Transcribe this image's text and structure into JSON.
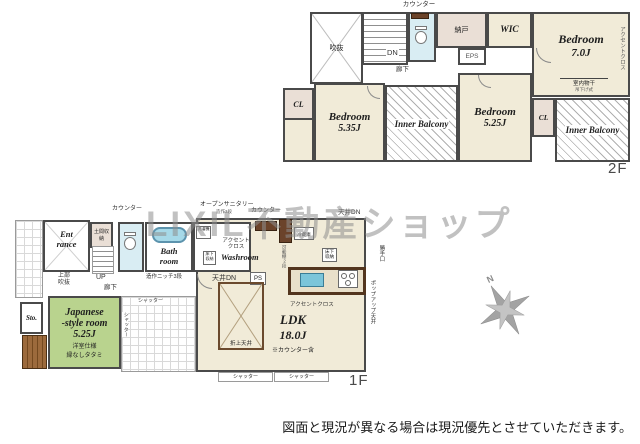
{
  "watermark": "LIXIL不動産ショップ",
  "disclaimer": "図面と現況が異なる場合は現況優先とさせていただきます。",
  "compass": {
    "north": "N"
  },
  "colors": {
    "floor_beige": "#f1ebd8",
    "closet_pink": "#eadfd6",
    "water_blue": "#d9edf3",
    "tatami_green": "#b9d38e",
    "wood_brown": "#6b432a",
    "wall_gray": "#4a4a4a",
    "watermark_gray": "#8f8f8f"
  },
  "f2": {
    "floor_label": "2F",
    "counter": "カウンター",
    "atrium": "吹抜",
    "dn": "DN",
    "hallway": "廊下",
    "nando": "納戸",
    "eps": "EPS",
    "wic": "WIC",
    "bed7_name": "Bedroom",
    "bed7_size": "7.0J",
    "accent_cloth": "アクセントクロス",
    "monohoshi": "室内物干",
    "monohoshi_sub": "吊下げ式",
    "cl_left": "CL",
    "bed535_name": "Bedroom",
    "bed535_size": "5.35J",
    "inner_balcony1": "Inner Balcony",
    "bed525_name": "Bedroom",
    "bed525_size": "5.25J",
    "cl_right": "CL",
    "inner_balcony2": "Inner Balcony"
  },
  "f1": {
    "floor_label": "1F",
    "entrance_l1": "Ent",
    "entrance_l2": "rance",
    "doma": "土間収納",
    "counter1": "カウンター",
    "open_sanitary": "オープンサニタリー",
    "open_sanitary_sub": "造作3段",
    "counter2": "カウンター",
    "ceiling_dn_top": "天井DN",
    "washer": "洗濯機",
    "bath_l1": "Bath",
    "bath_l2": "room",
    "accent1_l1": "アクセント",
    "accent1_l2": "クロス",
    "washroom": "Washroom",
    "floor_storage1": "床下収納",
    "fridge": "冷蔵庫",
    "movable_shelf": "可動棚2段",
    "floor_storage2": "床下収納",
    "katteguchi": "勝手口",
    "popup_ceiling": "ポップアップ天井",
    "up": "UP",
    "hallway": "廊下",
    "upper_void": "上部吹抜",
    "niche": "造作ニッチ3段",
    "ceiling_dn2": "天井DN",
    "ps": "PS",
    "sto": "Sto.",
    "jp_l1": "Japanese",
    "jp_l2": "-style room",
    "jp_size": "5.25J",
    "jp_sub1": "洋室仕様",
    "jp_sub2": "縁なしタタミ",
    "shutter": "シャッター",
    "oriage": "折上天井",
    "ldk_name": "LDK",
    "ldk_size": "18.0J",
    "ldk_note": "※カウンター含",
    "accent2": "アクセントクロス"
  }
}
